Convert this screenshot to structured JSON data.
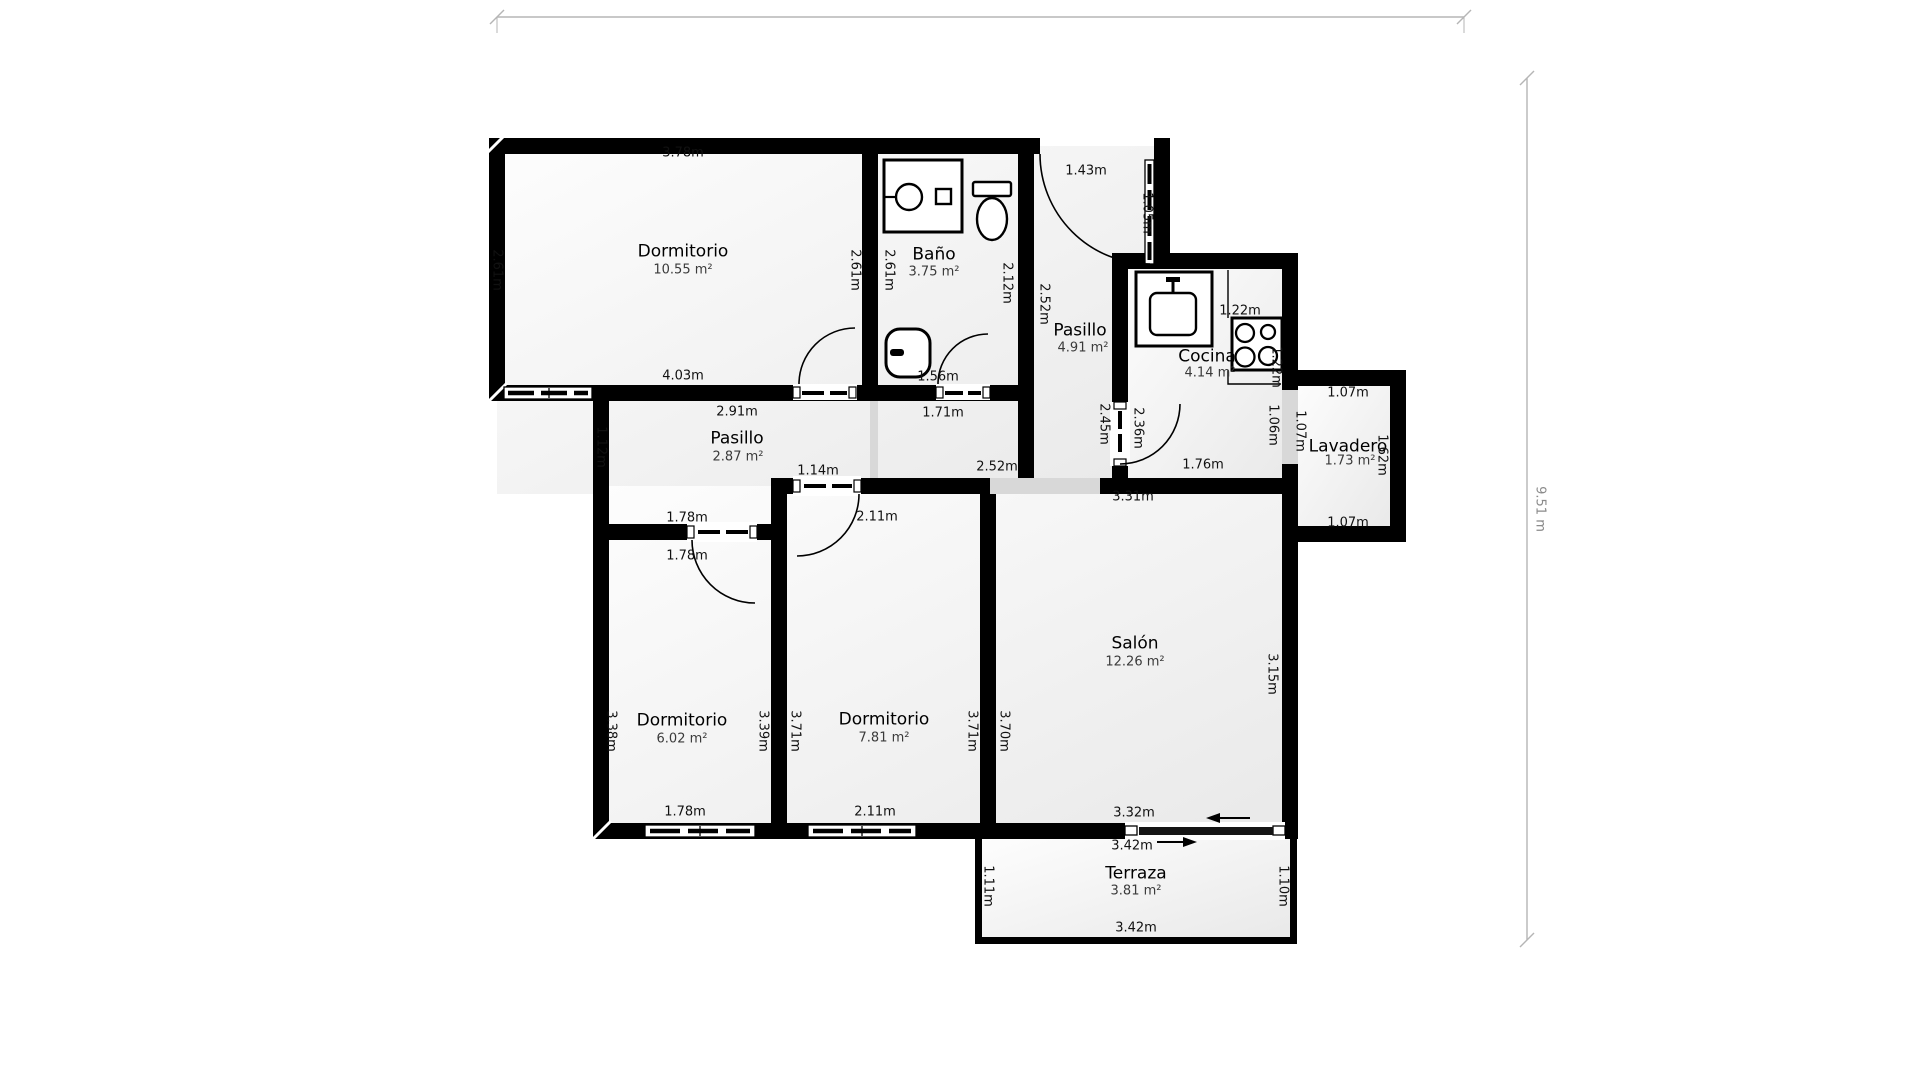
{
  "overall": {
    "height_label": "9.51 m"
  },
  "rooms": {
    "dormitorio_principal": {
      "name": "Dormitorio",
      "area": "10.55 m²",
      "dim_top": "3.78m",
      "dim_left": "2.61m",
      "dim_bottom": "4.03m",
      "dim_right": "2.61m"
    },
    "bano": {
      "name": "Baño",
      "area": "3.75 m²",
      "dim_left": "2.61m",
      "dim_right": "2.12m",
      "dim_door": "1.56m"
    },
    "pasillo_entrada": {
      "name": "Pasillo",
      "area": "4.91 m²",
      "dim_top": "1.43m",
      "dim_door": "1.05m",
      "dim_left": "2.52m",
      "dim_right": "2.45m"
    },
    "cocina": {
      "name": "Cocina",
      "area": "4.14 m²",
      "dim_sink": "1.22m",
      "dim_right_top": "1.22m",
      "dim_left": "2.36m",
      "dim_right_bottom": "1.06m",
      "dim_bottom": "1.76m"
    },
    "lavadero": {
      "name": "Lavadero",
      "area": "1.73 m²",
      "dim_top": "1.07m",
      "dim_left": "1.07m",
      "dim_right": "1.62m",
      "dim_bottom": "1.07m"
    },
    "pasillo_central": {
      "name": "Pasillo",
      "area": "2.87 m²",
      "dim_top": "2.91m",
      "dim_left": "1.12m",
      "dim_corridor": "1.71m",
      "dim_door_b": "1.78m",
      "dim_door_c": "1.14m",
      "dim_opening": "2.52m"
    },
    "dormitorio_2": {
      "name": "Dormitorio",
      "area": "6.02 m²",
      "dim_top": "1.78m",
      "dim_left": "3.38m",
      "dim_right": "3.39m",
      "dim_bottom": "1.78m"
    },
    "dormitorio_3": {
      "name": "Dormitorio",
      "area": "7.81 m²",
      "dim_top": "2.11m",
      "dim_left": "3.71m",
      "dim_right": "3.71m",
      "dim_bottom": "2.11m"
    },
    "salon": {
      "name": "Salón",
      "area": "12.26 m²",
      "dim_top": "3.31m",
      "dim_left": "3.70m",
      "dim_right": "3.15m",
      "dim_bottom": "3.32m",
      "dim_slider": "3.42m"
    },
    "terraza": {
      "name": "Terraza",
      "area": "3.81 m²",
      "dim_left": "1.11m",
      "dim_right": "1.10m",
      "dim_bottom": "3.42m"
    }
  },
  "colors": {
    "wall": "#000000",
    "floor": "#f2f2f2",
    "open_boundary": "#d8d8d8",
    "dimension_line": "#b5b5b5",
    "text": "#1a1a1a"
  }
}
